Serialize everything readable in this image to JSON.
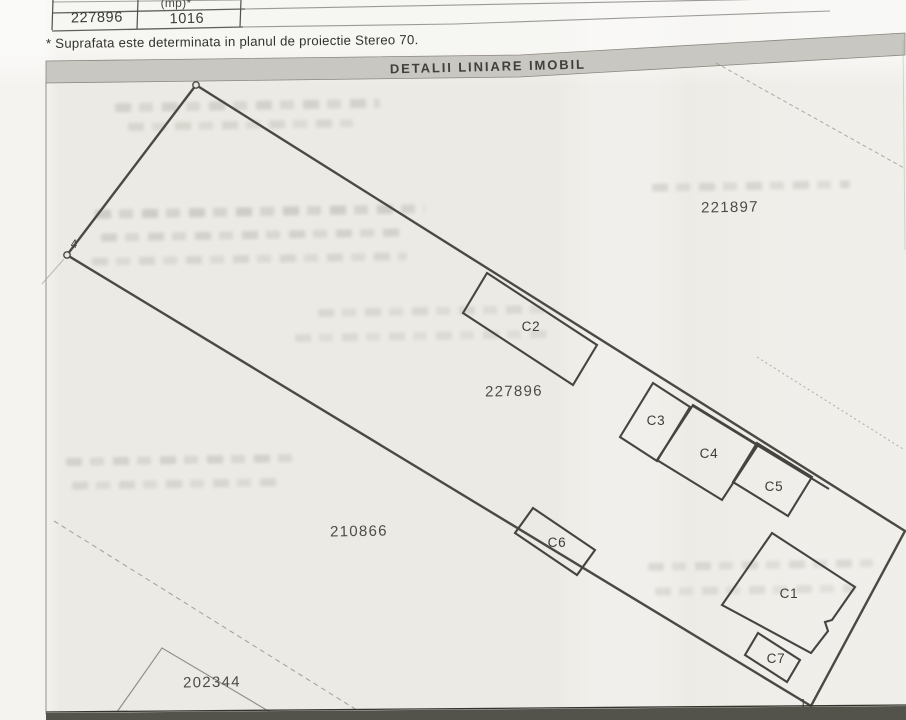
{
  "document": {
    "table": {
      "header_col2_partial": "(mp)*",
      "row": {
        "parcel_number": "227896",
        "area_mp": "1016",
        "col3": ""
      }
    },
    "footnote": "* Suprafata este determinata in planul de proiectie Stereo 70."
  },
  "map": {
    "title": "DETALII LINIARE IMOBIL",
    "parcel_labels": {
      "neighbor_top": "221897",
      "subject": "227896",
      "neighbor_lower": "210866",
      "neighbor_bottom_left": "202344"
    },
    "buildings": {
      "c1": "C1",
      "c2": "C2",
      "c3": "C3",
      "c4": "C4",
      "c5": "C5",
      "c6": "C6",
      "c7": "C7"
    },
    "points": {
      "p1": "1",
      "p4": "4"
    },
    "colors": {
      "boundary_line": "#4a4943",
      "building_line": "#454440",
      "faint_line": "#9a9991",
      "title_band": "#c9c7c1",
      "paper": "#eceae4",
      "bottom_bar": "#53524b"
    }
  }
}
